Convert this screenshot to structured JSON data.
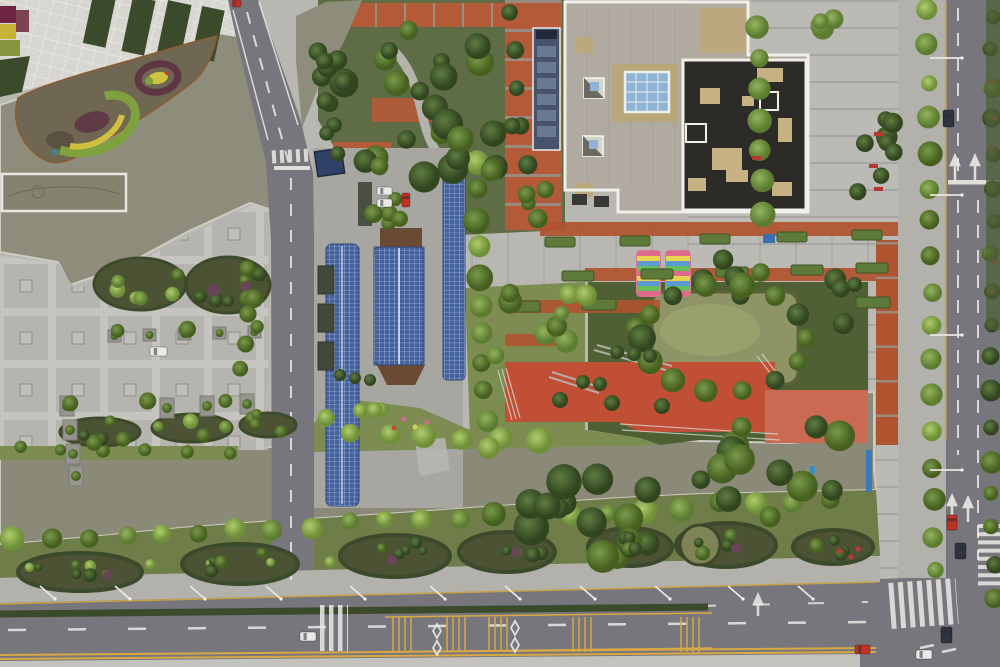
{
  "scene": {
    "description": "aerial-drone-photo-of-civic-plaza-with-canal-solar-carports-and-roads",
    "width": 1000,
    "height": 667
  },
  "palette": {
    "base": "#b8b7b1",
    "eastPlaza": "#bbbab4",
    "paver": "#a7a6a0",
    "water": "#8e8c7a",
    "canal": "#8b8977",
    "shoreWall": "#cdccc4",
    "road": "#77767c",
    "sidewalk": "#b2b1ab",
    "pale": "#c3c2bc",
    "laneWhite": "#eceae6",
    "laneYellow": "#d8a845",
    "curbYellow": "#c9a146",
    "lawn": "#7d8d52",
    "bank": "#6f7d48",
    "gardenDark": "#4e6034",
    "hedge": "#3c4a2c",
    "soil": "#4c5234",
    "redPave": "#b0532f",
    "redBrick": "#b55a38",
    "terrace": "#c04f36",
    "pinkSlab": "#ca6a52",
    "joint": "#9a9992",
    "solarBlue": "#44629e",
    "roofLight": "#b1aaa0",
    "roofTan": "#bba87e",
    "roofDark": "#2c2b27",
    "roofPatch": "#c6b183",
    "skylight": "#8fb3d4",
    "corridor": "#47536a",
    "frameWhite": "#f0efe9",
    "canopyBlue": "#2f4166",
    "railBlue": "#3a7abf",
    "carWhite": "#e9e9e7",
    "carRed": "#bf3226",
    "carDark": "#2e333e",
    "island": "#6f6752",
    "islandDark": "#5a5142",
    "swirlGreen": "#7fa03e",
    "swirlYellow": "#d2c13e",
    "maroon": "#5e3644",
    "pondGarden": "#8f9466",
    "stepGray": "#b7b6b0"
  },
  "rainbow": {
    "stripes": [
      "#e06a8e",
      "#e8d44e",
      "#5e9ad2",
      "#66bd5a",
      "#e06a8e",
      "#e8d44e",
      "#5e9ad2",
      "#66bd5a",
      "#e06a8e"
    ],
    "canopies": [
      {
        "x": 637,
        "y": 251,
        "w": 23,
        "h": 45
      },
      {
        "x": 666,
        "y": 251,
        "w": 24,
        "h": 45
      }
    ]
  },
  "scenery": {
    "tree_rows": [
      {
        "x": 15,
        "y": 541,
        "dx": 37,
        "dy": -1.9,
        "n": 23,
        "r": 10,
        "jr": 3,
        "c": "mixlight"
      },
      {
        "x": 30,
        "y": 567,
        "dx": 60,
        "dy": -1.0,
        "n": 6,
        "r": 5,
        "jr": 1,
        "c": "bright"
      },
      {
        "x": 352,
        "y": 431,
        "dx": 37,
        "dy": 2,
        "n": 6,
        "r": 11,
        "jr": 3,
        "c": "bright"
      },
      {
        "x": 477,
        "y": 160,
        "dx": 1,
        "dy": 29,
        "n": 11,
        "r": 11,
        "jr": 3,
        "c": "mixlight"
      },
      {
        "x": 757,
        "y": 27,
        "dx": 1,
        "dy": 31,
        "n": 7,
        "r": 11,
        "jr": 2,
        "c": "light"
      },
      {
        "x": 928,
        "y": 12,
        "dx": 0.5,
        "dy": 35,
        "n": 17,
        "r": 10,
        "jr": 3,
        "c": "mixlight"
      },
      {
        "x": 993,
        "y": 18,
        "dx": 0,
        "dy": 34,
        "n": 18,
        "r": 9,
        "jr": 3,
        "c": "mixdark"
      },
      {
        "x": 318,
        "y": 52,
        "dx": 5,
        "dy": 25,
        "n": 5,
        "r": 9,
        "jr": 2,
        "c": "dark"
      },
      {
        "x": 118,
        "y": 331,
        "dx": 70,
        "dy": -2,
        "n": 3,
        "r": 7,
        "jr": 1,
        "c": "mid"
      },
      {
        "x": 70,
        "y": 404,
        "dx": 78,
        "dy": -2,
        "n": 3,
        "r": 7,
        "jr": 1,
        "c": "mid"
      },
      {
        "x": 20,
        "y": 448,
        "dx": 42,
        "dy": 1,
        "n": 6,
        "r": 6,
        "jr": 2,
        "c": "mid"
      },
      {
        "x": 510,
        "y": 12,
        "dx": 4,
        "dy": 38,
        "n": 6,
        "r": 8,
        "jr": 2,
        "c": "mixdark"
      }
    ],
    "tree_clusters": [
      {
        "x": 438,
        "y": 108,
        "rx": 100,
        "ry": 90,
        "n": 26,
        "r0": 8,
        "r1": 16,
        "c": "mixdark"
      },
      {
        "x": 332,
        "y": 100,
        "rx": 16,
        "ry": 48,
        "n": 6,
        "r0": 7,
        "r1": 11,
        "c": "dark"
      },
      {
        "x": 396,
        "y": 206,
        "rx": 33,
        "ry": 18,
        "n": 5,
        "r0": 7,
        "r1": 10,
        "c": "mid"
      },
      {
        "x": 560,
        "y": 330,
        "rx": 78,
        "ry": 50,
        "n": 10,
        "r0": 7,
        "r1": 12,
        "c": "mixlight"
      },
      {
        "x": 770,
        "y": 465,
        "rx": 85,
        "ry": 52,
        "n": 13,
        "r0": 9,
        "r1": 16,
        "c": "mixdark"
      },
      {
        "x": 600,
        "y": 515,
        "rx": 85,
        "ry": 55,
        "n": 15,
        "r0": 10,
        "r1": 18,
        "c": "mixdark"
      },
      {
        "x": 872,
        "y": 148,
        "rx": 26,
        "ry": 60,
        "n": 8,
        "r0": 8,
        "r1": 12,
        "c": "dark"
      },
      {
        "x": 140,
        "y": 283,
        "rx": 42,
        "ry": 24,
        "n": 7,
        "r0": 5,
        "r1": 9,
        "c": "mixlight"
      },
      {
        "x": 228,
        "y": 284,
        "rx": 38,
        "ry": 26,
        "n": 6,
        "r0": 5,
        "r1": 9,
        "c": "mixdark"
      },
      {
        "x": 100,
        "y": 431,
        "rx": 38,
        "ry": 13,
        "n": 5,
        "r0": 5,
        "r1": 8,
        "c": "mixdark"
      },
      {
        "x": 192,
        "y": 427,
        "rx": 38,
        "ry": 13,
        "n": 5,
        "r0": 5,
        "r1": 8,
        "c": "mixlight"
      },
      {
        "x": 268,
        "y": 424,
        "rx": 26,
        "ry": 11,
        "n": 4,
        "r0": 5,
        "r1": 8,
        "c": "mid"
      },
      {
        "x": 250,
        "y": 338,
        "rx": 13,
        "ry": 48,
        "n": 5,
        "r0": 7,
        "r1": 10,
        "c": "mid"
      },
      {
        "x": 840,
        "y": 24,
        "rx": 26,
        "ry": 18,
        "n": 4,
        "r0": 8,
        "r1": 12,
        "c": "light"
      },
      {
        "x": 540,
        "y": 203,
        "rx": 20,
        "ry": 16,
        "n": 4,
        "r0": 7,
        "r1": 10,
        "c": "mid"
      },
      {
        "x": 730,
        "y": 278,
        "rx": 34,
        "ry": 22,
        "n": 5,
        "r0": 8,
        "r1": 12,
        "c": "mixdark"
      },
      {
        "x": 846,
        "y": 300,
        "rx": 18,
        "ry": 28,
        "n": 4,
        "r0": 7,
        "r1": 11,
        "c": "dark"
      },
      {
        "x": 80,
        "y": 571,
        "rx": 48,
        "ry": 13,
        "n": 5,
        "r0": 4,
        "r1": 8,
        "c": "mixdark"
      },
      {
        "x": 240,
        "y": 562,
        "rx": 45,
        "ry": 13,
        "n": 5,
        "r0": 4,
        "r1": 8,
        "c": "mixdark"
      },
      {
        "x": 395,
        "y": 554,
        "rx": 42,
        "ry": 14,
        "n": 5,
        "r0": 4,
        "r1": 8,
        "c": "mixdark"
      },
      {
        "x": 507,
        "y": 550,
        "rx": 36,
        "ry": 13,
        "n": 4,
        "r0": 4,
        "r1": 8,
        "c": "mixdark"
      },
      {
        "x": 630,
        "y": 546,
        "rx": 30,
        "ry": 13,
        "n": 4,
        "r0": 4,
        "r1": 8,
        "c": "mixdark"
      },
      {
        "x": 726,
        "y": 544,
        "rx": 36,
        "ry": 14,
        "n": 5,
        "r0": 4,
        "r1": 8,
        "c": "mixdark"
      },
      {
        "x": 833,
        "y": 546,
        "rx": 30,
        "ry": 11,
        "n": 4,
        "r0": 4,
        "r1": 8,
        "c": "mixdark"
      },
      {
        "x": 360,
        "y": 418,
        "rx": 40,
        "ry": 11,
        "n": 4,
        "r0": 5,
        "r1": 9,
        "c": "bright"
      }
    ],
    "tree_rings": [
      {
        "x": 724,
        "y": 338,
        "rx": 82,
        "ry": 54,
        "n": 14,
        "r0": 9,
        "r1": 14,
        "c": "mixdark"
      }
    ],
    "beds": [
      {
        "x": 80,
        "y": 572,
        "rx": 62,
        "ry": 19
      },
      {
        "x": 240,
        "y": 564,
        "rx": 58,
        "ry": 20
      },
      {
        "x": 395,
        "y": 556,
        "rx": 55,
        "ry": 21
      },
      {
        "x": 507,
        "y": 552,
        "rx": 48,
        "ry": 20
      },
      {
        "x": 630,
        "y": 547,
        "rx": 42,
        "ry": 19
      },
      {
        "x": 726,
        "y": 545,
        "rx": 50,
        "ry": 22
      },
      {
        "x": 833,
        "y": 547,
        "rx": 40,
        "ry": 17
      }
    ],
    "plaza_beds": [
      {
        "x": 140,
        "y": 284,
        "rx": 46,
        "ry": 26
      },
      {
        "x": 228,
        "y": 285,
        "rx": 42,
        "ry": 28
      },
      {
        "x": 100,
        "y": 432,
        "rx": 40,
        "ry": 14
      },
      {
        "x": 192,
        "y": 428,
        "rx": 40,
        "ry": 14
      },
      {
        "x": 268,
        "y": 425,
        "rx": 28,
        "ry": 12
      }
    ],
    "planters_h": [
      {
        "x": 108,
        "y": 330
      },
      {
        "x": 143,
        "y": 329
      },
      {
        "x": 178,
        "y": 328
      },
      {
        "x": 213,
        "y": 327
      },
      {
        "x": 248,
        "y": 326
      }
    ],
    "planters_v": [
      {
        "x": 60,
        "y": 396
      },
      {
        "x": 63,
        "y": 420
      },
      {
        "x": 66,
        "y": 444
      },
      {
        "x": 69,
        "y": 466
      },
      {
        "x": 160,
        "y": 398
      },
      {
        "x": 200,
        "y": 396
      },
      {
        "x": 240,
        "y": 394
      }
    ],
    "hedge_planters": [
      {
        "x": 545,
        "y": 237,
        "w": 30,
        "h": 10
      },
      {
        "x": 620,
        "y": 236,
        "w": 30,
        "h": 10
      },
      {
        "x": 700,
        "y": 234,
        "w": 30,
        "h": 10
      },
      {
        "x": 777,
        "y": 232,
        "w": 30,
        "h": 10
      },
      {
        "x": 852,
        "y": 230,
        "w": 30,
        "h": 10
      },
      {
        "x": 562,
        "y": 271,
        "w": 32,
        "h": 10
      },
      {
        "x": 641,
        "y": 269,
        "w": 32,
        "h": 10
      },
      {
        "x": 716,
        "y": 267,
        "w": 32,
        "h": 10
      },
      {
        "x": 791,
        "y": 265,
        "w": 32,
        "h": 10
      },
      {
        "x": 856,
        "y": 263,
        "w": 32,
        "h": 10
      },
      {
        "x": 506,
        "y": 301,
        "w": 34,
        "h": 11
      },
      {
        "x": 582,
        "y": 299,
        "w": 34,
        "h": 11
      },
      {
        "x": 856,
        "y": 297,
        "w": 34,
        "h": 11
      }
    ],
    "shrubs": [
      {
        "x": 560,
        "y": 400,
        "r": 8
      },
      {
        "x": 612,
        "y": 403,
        "r": 8
      },
      {
        "x": 662,
        "y": 406,
        "r": 8
      },
      {
        "x": 617,
        "y": 352,
        "r": 7
      },
      {
        "x": 634,
        "y": 354,
        "r": 7
      },
      {
        "x": 650,
        "y": 356,
        "r": 7
      },
      {
        "x": 583,
        "y": 382,
        "r": 7
      },
      {
        "x": 600,
        "y": 384,
        "r": 7
      },
      {
        "x": 340,
        "y": 375,
        "r": 6
      },
      {
        "x": 355,
        "y": 378,
        "r": 6
      },
      {
        "x": 370,
        "y": 380,
        "r": 6
      }
    ],
    "purple_shrubs": [
      {
        "x": 214,
        "y": 290,
        "r": 6
      },
      {
        "x": 246,
        "y": 286,
        "r": 5
      },
      {
        "x": 392,
        "y": 560,
        "r": 5
      },
      {
        "x": 516,
        "y": 552,
        "r": 5
      },
      {
        "x": 736,
        "y": 548,
        "r": 5
      },
      {
        "x": 108,
        "y": 575,
        "r": 5
      }
    ],
    "flowers": [
      {
        "x": 404,
        "y": 419,
        "c": "#cf6a8c"
      },
      {
        "x": 415,
        "y": 427,
        "c": "#d8cf4c"
      },
      {
        "x": 427,
        "y": 422,
        "c": "#cf6a8c"
      },
      {
        "x": 394,
        "y": 428,
        "c": "#c84848"
      },
      {
        "x": 840,
        "y": 551,
        "c": "#c23737"
      },
      {
        "x": 851,
        "y": 557,
        "c": "#c23737"
      },
      {
        "x": 858,
        "y": 549,
        "c": "#c23737"
      },
      {
        "x": 992,
        "y": 82,
        "c": "#c04858"
      },
      {
        "x": 995,
        "y": 118,
        "c": "#c04858"
      },
      {
        "x": 991,
        "y": 148,
        "c": "#c04858"
      },
      {
        "x": 994,
        "y": 262,
        "c": "#c04858"
      },
      {
        "x": 992,
        "y": 292,
        "c": "#c04858"
      }
    ],
    "cars": [
      {
        "x": 150,
        "y": 347,
        "w": 17,
        "h": 9,
        "c": "carWhite"
      },
      {
        "x": 377,
        "y": 187,
        "w": 15,
        "h": 8,
        "c": "carWhite"
      },
      {
        "x": 377,
        "y": 199,
        "w": 15,
        "h": 8,
        "c": "carWhite"
      },
      {
        "x": 402,
        "y": 193,
        "w": 8,
        "h": 14,
        "c": "carRed"
      },
      {
        "x": 300,
        "y": 632,
        "w": 16,
        "h": 9,
        "c": "carWhite"
      },
      {
        "x": 855,
        "y": 645,
        "w": 15,
        "h": 9,
        "c": "carRed"
      },
      {
        "x": 941,
        "y": 627,
        "w": 11,
        "h": 16,
        "c": "carDark"
      },
      {
        "x": 955,
        "y": 543,
        "w": 11,
        "h": 16,
        "c": "carDark"
      },
      {
        "x": 947,
        "y": 515,
        "w": 10,
        "h": 15,
        "c": "carRed"
      },
      {
        "x": 943,
        "y": 110,
        "w": 11,
        "h": 17,
        "c": "carDark"
      },
      {
        "x": 916,
        "y": 650,
        "w": 16,
        "h": 9,
        "c": "carWhite"
      },
      {
        "x": 232,
        "y": 0,
        "w": 9,
        "h": 7,
        "c": "carRed"
      }
    ],
    "benches": [
      {
        "x": 874,
        "y": 132
      },
      {
        "x": 869,
        "y": 164
      },
      {
        "x": 874,
        "y": 187
      },
      {
        "x": 752,
        "y": 156
      }
    ],
    "lamps_bottom": [
      40,
      115,
      190,
      266,
      350,
      430,
      505,
      580,
      655,
      728,
      798
    ],
    "lamps_right": [
      58,
      195,
      335,
      470
    ],
    "bus_lane": {
      "xs": [
        393,
        447,
        489,
        573,
        681
      ],
      "count": 4,
      "gap": 6,
      "y0": 617,
      "y1": 652
    },
    "joints": [
      {
        "type": "h",
        "x0": 690,
        "x1": 944,
        "y0": 18,
        "step": 27,
        "n": 21
      },
      {
        "type": "v",
        "y0": 224,
        "y1": 420,
        "x0": 472,
        "step": 36,
        "n": 13
      }
    ]
  }
}
